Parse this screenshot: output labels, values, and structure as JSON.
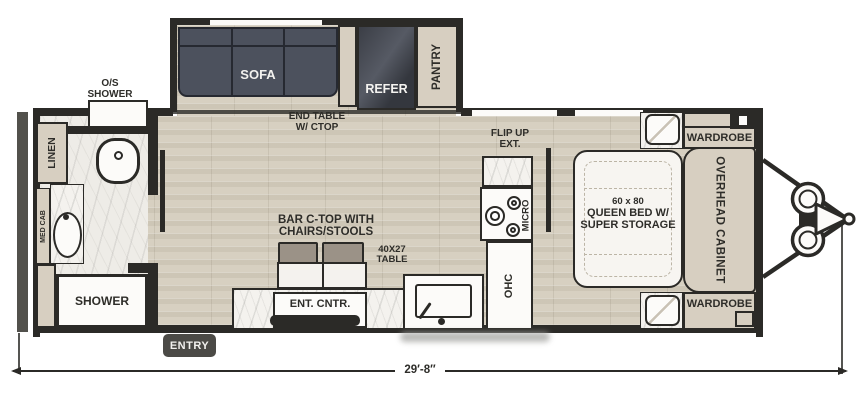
{
  "labels": {
    "os_shower": "O/S\nSHOWER",
    "linen": "LINEN",
    "med_cab": "MED CAB",
    "shower": "SHOWER",
    "sofa": "SOFA",
    "end_table": "END TABLE\nW/ CTOP",
    "refer": "REFER",
    "pantry": "PANTRY",
    "flip_up": "FLIP UP\nEXT.",
    "micro": "MICRO",
    "ohc": "OHC",
    "bar_ctop": "BAR C-TOP WITH\nCHAIRS/STOOLS",
    "table_40x27": "40X27\nTABLE",
    "ent_cntr": "ENT. CNTR.",
    "entry": "ENTRY",
    "bed_size": "60 x 80",
    "bed_main": "QUEEN BED W/\nSUPER STORAGE",
    "wardrobe_top": "WARDROBE",
    "wardrobe_bottom": "WARDROBE",
    "overhead": "OVERHEAD CABINET"
  },
  "dimension": {
    "length": "29′-8″"
  },
  "colors": {
    "wall": "#2b2a27",
    "bumper": "#52514c",
    "wood": "#d7d0c1",
    "marble": "#eeece7",
    "counter": "#f4f2ee",
    "cabinet": "#d7cfc1",
    "sofa": "#4c515d",
    "stool": "#9b9287",
    "white": "#fcfbf9",
    "badge": "#4b4a46",
    "text": "#2e2d29",
    "dash": "#bcb5a6"
  }
}
